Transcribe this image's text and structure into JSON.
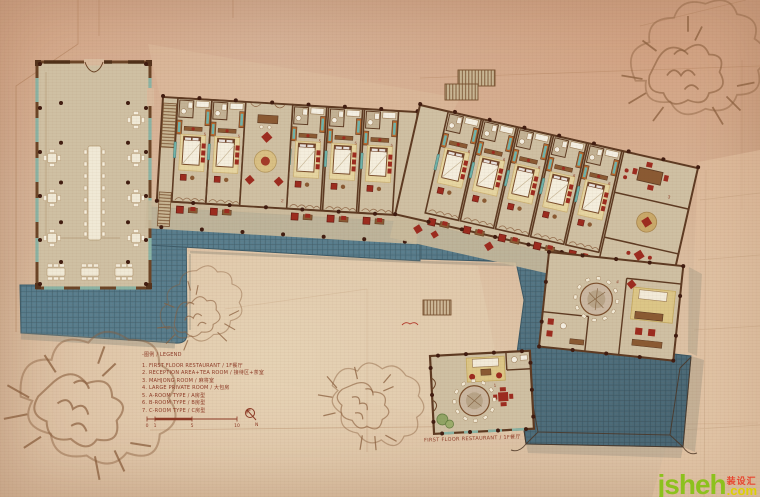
{
  "legend": {
    "header": "-图例 / LEGEND",
    "items": [
      "1. FIRST FLOOR RESTAURANT / 1F餐厅",
      "2. RECEPTION AREA+TEA ROOM / 接待区+茶室",
      "3. MAHJONG ROOM / 麻将室",
      "4. LARGE PRIVATE ROOM / 大包房",
      "5. A-ROOM TYPE / A房型",
      "6. B-ROOM TYPE / B房型",
      "7. C-ROOM TYPE / C房型"
    ]
  },
  "scale": {
    "ticks": [
      "0",
      "1",
      "5",
      "10"
    ]
  },
  "north": "N",
  "restaurant_label": "FIRST FLOOR RESTAURANT / 1F餐厅",
  "room_numbers": {
    "restaurant": "1",
    "lounge": "2",
    "mahjong": "3",
    "private": "4",
    "west_room": "5",
    "east_room": "6",
    "c_room": "7"
  },
  "watermark": {
    "brand": "jsheh",
    "cn": "装设汇",
    "tld": ".com"
  },
  "colors": {
    "paper": "#d9ba9d",
    "floor": "#cfc0a3",
    "wall": "#5d3a22",
    "column": "#401c10",
    "tile_blue": "#577c8b",
    "tile_line": "#3d5b68",
    "furniture_red": "#9c2b1f",
    "rug_yellow": "#e0cc92",
    "window_teal": "#6fb3ab",
    "wood": "#8a5a33",
    "tree_brown": "#8a5f3e",
    "text_red": "#8c3a26",
    "watermark_green": "#8cc11d",
    "watermark_yellow": "#ddd104",
    "watermark_red": "#e8452e"
  }
}
